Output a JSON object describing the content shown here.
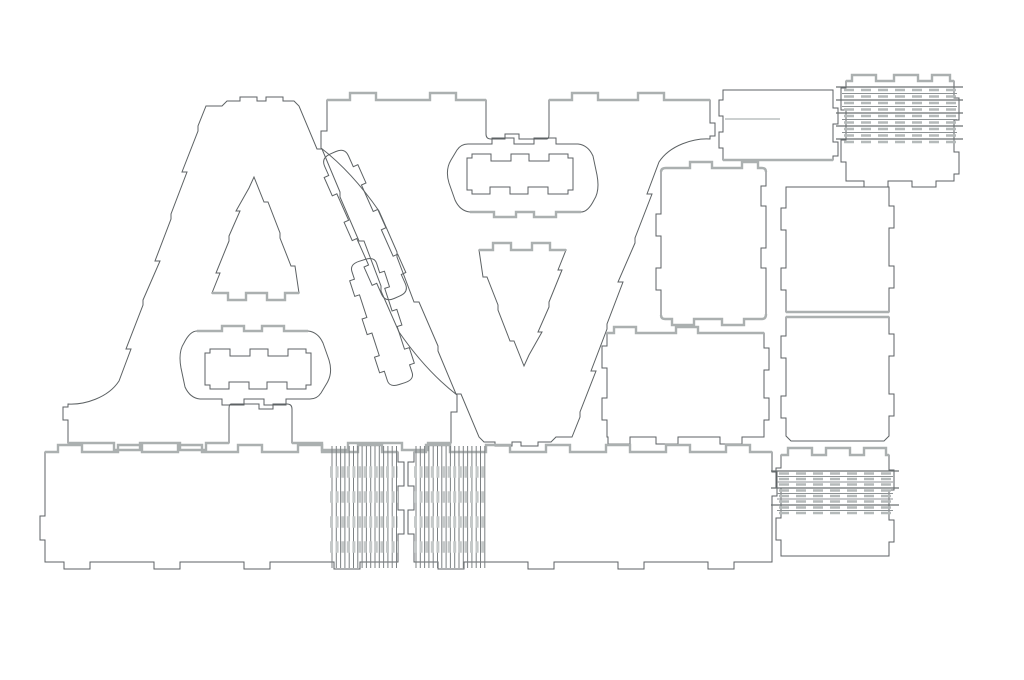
{
  "canvas": {
    "width": 1024,
    "height": 680,
    "background": "#ffffff"
  },
  "palette": {
    "cut": "#5d6264",
    "accent": "#abb0b0",
    "hinge_frame": "#6a6f71",
    "hinge_thin": "#8d9294",
    "hinge_dash": "#b5baba",
    "hinge_vertical": "#7c8183",
    "hinge_band": "#c5c9c9",
    "score": "#9aa0a0",
    "fill": "none"
  },
  "sheet": {
    "description": "laser-cut plywood letter kit cutting layout",
    "letter": "A",
    "letter_count": 2,
    "piece_kinds": [
      "letter-face",
      "crossbar-insert",
      "diagonal-wall-strip",
      "side-panel",
      "score-plate",
      "living-hinge-panel",
      "bottom-wall-strip"
    ]
  },
  "groups": [
    {
      "id": "letter-upright",
      "name": "letter-a-upright-group",
      "transform": ""
    },
    {
      "id": "letter-inverted",
      "name": "letter-a-inverted-group",
      "transform": "translate(254 0) rotate(180 262 271.5)"
    }
  ],
  "letter_paths": [
    {
      "id": "a-face",
      "name": "letter-a-face-outline",
      "d": "M 222,106 L 227,101 H 240 V 97 H 257 V 101 H 266 V 97 H 283 V 101 H 294 L 299,106 L 317,149 H 322 L 340,192 V 197 L 359,241 H 364 L 381,286 V 291 L 399,332 Q 426,371 457,395 V 412 H 451 V 443 H 428 V 450 H 402 V 443 H 348 V 450 H 322 V 443 H 292 V 409 Q 292,404 287,404 H 273 V 409 H 259 V 404 H 231 Q 229,404 229,409 V 443 H 206 V 450 H 180 V 443 H 140 V 450 H 114 V 443 H 68 V 420 H 63 V 407 H 68 V 404 C 84,405 108,398 119,381 L 131,349 H 126 L 143,305 V 300 L 160,261 H 155 L 171,219 V 214 L 187,172 H 182 L 198,131 V 126 L 206,106 Z M 254,177 L 264,202 H 268 L 280,233 V 238 L 291,266 H 295 L 299,293 H 285 V 300 H 267 V 293 H 246 V 300 H 228 V 293 H 212 L 220,273 H 216 L 229,241 V 236 L 240,211 H 236 L 249,188 Z M 197,331 H 222 V 326 H 244 V 331 H 262 V 326 H 284 V 331 H 308 Q 318,332 323,343 L 329,360 Q 333,373 327,383 L 321,393 Q 317,399 310,399 H 286 V 405 H 264 V 399 H 244 V 405 H 222 V 399 H 200 Q 190,398 185,387 L 181,368 Q 178,352 184,343 Q 190,331 197,331 Z"
    },
    {
      "id": "crossbar-insert",
      "name": "crossbar-insert-piece",
      "d": "M 210,349 H 230 V 356 H 250 V 349 H 268 V 356 H 288 V 349 H 306 V 353 H 311 V 385 H 306 V 389 H 287 V 382 H 267 V 389 H 249 V 382 H 229 V 389 H 210 V 385 H 205 V 353 H 210 Z"
    },
    {
      "id": "acc-stadium",
      "name": "stadium-top-accent",
      "class": "accent",
      "d": "M 197,331 H 222 V 326 H 244 V 331 H 262 V 326 H 284 V 331 H 308"
    },
    {
      "id": "acc-tri",
      "name": "triangle-base-accent",
      "class": "accent",
      "d": "M 299,293 H 285 V 300 H 267 V 293 H 246 V 300 H 228 V 293 H 212"
    },
    {
      "id": "acc-foot-l",
      "name": "left-foot-accent",
      "class": "accent",
      "d": "M 229,443 H 206 V 450 H 180 V 443 H 140 V 450 H 114 V 443 H 68"
    },
    {
      "id": "acc-foot-r",
      "name": "right-foot-accent",
      "class": "accent",
      "d": "M 451,443 H 428 V 450 H 402 V 443 H 348 V 450 H 322 V 443 H 292"
    }
  ],
  "pieces": [
    {
      "id": "strip-1",
      "name": "diagonal-wall-strip-1",
      "transform": "translate(365 225) rotate(66)",
      "d": "M -70,-13 H -58 V -18 H -38 V -13 H -9 V -18 H 11 V -13 H 40 V -18 H 60 V -13 H 70 Q 79,-13 79,-3 V 3 Q 79,13 70,13 H 58 V 18 H 38 V 13 H 9 V 18 H -11 V 13 H -40 V 18 H -60 V 13 H -70 Q -79,13 -79,3 V -3 Q -79,-13 -70,-13 Z"
    },
    {
      "id": "strip-2",
      "name": "diagonal-wall-strip-2",
      "transform": "translate(382 322) rotate(72) scale(0.82 1)",
      "d": "M -70,-13 H -58 V -18 H -38 V -13 H -9 V -18 H 11 V -13 H 40 V -18 H 60 V -13 H 70 Q 79,-13 79,-3 V 3 Q 79,13 70,13 H 58 V 18 H 38 V 13 H 9 V 18 H -11 V 13 H -40 V 18 H -60 V 13 H -70 Q -79,13 -79,3 V -3 Q -79,-13 -70,-13 Z"
    },
    {
      "id": "panel-1",
      "name": "side-panel-rounded-tall",
      "d": "M 666,168 H 690 V 162 H 712 V 168 H 742 V 162 H 758 V 168 H 762 Q 766,168 766,172 V 186 H 761 V 206 H 766 V 248 H 761 V 268 H 766 V 314 Q 766,319 762,319 H 744 V 325 H 722 V 319 H 694 V 325 H 672 V 319 H 665 Q 661,319 661,315 V 290 H 656 V 268 H 661 V 236 H 656 V 214 H 661 V 172 Q 661,168 666,168 Z"
    },
    {
      "id": "panel-2",
      "name": "side-panel-upper-right",
      "d": "M 786,187 H 889 V 206 H 894 V 228 H 889 V 266 H 894 V 288 H 889 V 312 H 786 V 290 H 781 V 268 H 786 V 230 H 781 V 208 H 786 Z"
    },
    {
      "id": "panel-3",
      "name": "side-panel-lower-right",
      "d": "M 786,317 H 889 V 334 H 894 V 356 H 889 V 394 H 894 V 416 H 889 V 436 L 884,441 H 791 L 786,436 V 418 H 781 V 396 H 786 V 358 H 781 V 336 H 786 Z"
    },
    {
      "id": "panel-4",
      "name": "side-panel-wide",
      "d": "M 607,333 H 614 V 327 H 636 V 333 H 676 V 327 H 698 V 333 H 764 V 348 H 769 V 370 H 764 V 398 H 769 V 420 H 764 V 437 H 742 V 444 H 720 V 437 H 678 V 444 H 656 V 437 H 630 V 444 H 608 V 437 H 607 V 420 H 602 V 398 H 607 V 368 H 602 V 346 H 607 Z"
    },
    {
      "id": "score-plate",
      "name": "score-plate",
      "d": "M 723,90 H 833 V 108 H 838 V 124 H 833 V 142 H 838 V 156 H 833 V 160 H 723 V 148 H 719 V 132 H 723 V 116 H 719 V 100 H 723 Z"
    },
    {
      "id": "hinge-panel-1",
      "name": "living-hinge-panel-top-right",
      "d": "M 846,81 H 852 V 75 H 876 V 81 H 894 V 75 H 918 V 81 H 932 V 75 H 950 V 81 H 954 V 98 H 959 V 120 H 954 V 152 H 959 V 174 H 954 V 181 H 936 V 187 H 912 V 181 H 888 V 187 H 864 V 181 H 846 V 162 H 841 V 140 H 846 V 110 H 841 V 88 H 846 Z"
    },
    {
      "id": "hinge-panel-2",
      "name": "living-hinge-panel-bottom-right",
      "d": "M 781,455 H 788 V 448 H 812 V 455 H 826 V 448 H 850 V 455 H 864 V 448 H 886 V 455 H 889 V 470 H 894 V 490 H 889 V 520 H 894 V 542 H 889 V 556 H 781 V 540 H 776 V 518 H 781 V 488 H 776 V 468 H 781 Z"
    },
    {
      "id": "bottom-strip-1",
      "name": "bottom-wall-strip-left",
      "d": "M 45,452 H 58 V 445 H 82 V 452 H 118 V 445 H 142 V 452 H 178 V 445 H 202 V 452 H 238 V 445 H 262 V 452 H 298 V 445 H 322 V 452 H 358 V 445 H 382 V 452 H 398 V 462 H 404 V 486 H 398 V 510 H 404 V 534 H 398 V 562 H 360 V 569 H 334 V 562 H 270 V 569 H 244 V 562 H 180 V 569 H 154 V 562 H 90 V 569 H 64 V 562 H 45 V 540 H 40 V 516 H 45 Z"
    },
    {
      "id": "bottom-strip-2",
      "name": "bottom-wall-strip-right",
      "d": "M 414,452 H 426 V 445 H 450 V 452 H 486 V 445 H 510 V 452 H 546 V 445 H 570 V 452 H 606 V 445 H 630 V 452 H 666 V 445 H 690 V 452 H 726 V 445 H 750 V 452 H 772 V 472 H 777 V 496 H 772 V 562 H 734 V 569 H 708 V 562 H 644 V 569 H 618 V 562 H 554 V 569 H 528 V 562 H 464 V 569 H 438 V 562 H 414 V 534 H 408 V 510 H 414 V 486 H 408 V 462 H 414 Z"
    }
  ],
  "accent_pieces": [
    {
      "id": "acc-s1-top",
      "name": "strip-left-top-accent",
      "d": "M 45,452 H 58 V 445 H 82 V 452 H 118 V 445 H 142 V 452 H 178 V 445 H 202 V 452 H 238 V 445 H 262 V 452 H 298 V 445 H 322 V 452 H 358 V 445 H 382 V 452 H 398"
    },
    {
      "id": "acc-s2-top",
      "name": "strip-right-top-accent",
      "d": "M 414,452 H 426 V 445 H 450 V 452 H 486 V 445 H 510 V 452 H 546 V 445 H 570 V 452 H 606 V 445 H 630 V 452 H 666 V 445 H 690 V 452 H 726 V 445 H 750 V 452 H 772"
    },
    {
      "id": "acc-p4-top",
      "name": "panel-wide-top-accent",
      "d": "M 607,333 H 614 V 327 H 636 V 333 H 676 V 327 H 698 V 333 H 764"
    },
    {
      "id": "acc-p1-top",
      "name": "panel-tall-top-accent",
      "d": "M 661,172 Q 661,168 666,168 H 690 V 162 H 712 V 168 H 742 V 162 H 758 V 168 H 762 Q 766,168 766,172"
    },
    {
      "id": "acc-p1-bottom",
      "name": "panel-tall-bottom-accent",
      "d": "M 766,314 Q 766,319 762,319 H 744 V 325 H 722 V 319 H 694 V 325 H 672 V 319 H 665 Q 661,319 661,315"
    },
    {
      "id": "acc-p2-bottom",
      "name": "panel-upper-right-bottom-accent",
      "d": "M 786,312 H 889"
    },
    {
      "id": "acc-p3-top",
      "name": "panel-lower-right-top-accent",
      "d": "M 786,317 H 889"
    },
    {
      "id": "acc-r-bottom",
      "name": "score-plate-bottom-accent",
      "d": "M 723,160 H 833"
    },
    {
      "id": "acc-h1-top",
      "name": "hinge-panel-1-top-accent",
      "d": "M 846,81 H 852 V 75 H 876 V 81 H 894 V 75 H 918 V 81 H 932 V 75 H 950 V 81 H 954"
    },
    {
      "id": "acc-h2-top",
      "name": "hinge-panel-2-top-accent",
      "d": "M 781,455 H 788 V 448 H 812 V 455 H 826 V 448 H 850 V 455 H 864 V 448 H 886 V 455 H 889"
    }
  ],
  "line_groups": [
    {
      "id": "h1-frame",
      "name": "hinge-1-frame-lines",
      "axis": "h",
      "from": 836,
      "to": 963,
      "at": [
        87,
        100,
        113,
        126,
        139
      ],
      "color": "hinge_frame",
      "width": 1.2
    },
    {
      "id": "h1-thin",
      "name": "hinge-1-thin-lines",
      "axis": "h",
      "from": 842,
      "to": 957,
      "at": [
        93.5,
        106.5,
        119.5,
        132.5
      ],
      "color": "hinge_thin",
      "width": 1
    },
    {
      "id": "h1-dash",
      "name": "hinge-1-dash-rows",
      "axis": "h",
      "from": 844,
      "to": 956,
      "at": [
        90,
        96.5,
        103,
        109.5,
        116,
        122.5,
        129,
        135.5,
        142
      ],
      "color": "hinge_dash",
      "width": 2.4,
      "dash": "10 7"
    },
    {
      "id": "h2-frame",
      "name": "hinge-2-frame-lines",
      "axis": "h",
      "from": 771,
      "to": 899,
      "at": [
        471,
        488,
        505
      ],
      "color": "hinge_frame",
      "width": 1.2
    },
    {
      "id": "h2-thin",
      "name": "hinge-2-thin-lines",
      "axis": "h",
      "from": 777,
      "to": 893,
      "at": [
        476.5,
        482,
        493.5,
        499,
        510.5
      ],
      "color": "hinge_thin",
      "width": 1
    },
    {
      "id": "h2-dash",
      "name": "hinge-2-dash-rows",
      "axis": "h",
      "from": 779,
      "to": 891,
      "at": [
        473.5,
        479,
        484.5,
        490.5,
        496,
        501.5,
        507.5,
        513
      ],
      "color": "hinge_dash",
      "width": 2.4,
      "dash": "10 7"
    },
    {
      "id": "s1-vlines",
      "name": "bottom-strip-1-hinge-lines",
      "axis": "v",
      "from": 446,
      "to": 568,
      "at": [
        332,
        336.3,
        340.6,
        344.9,
        349.2,
        353.5,
        357.8,
        362.1,
        366.4,
        370.7,
        375,
        379.3,
        383.6,
        387.9,
        392.2,
        396.5
      ],
      "color": "hinge_vertical",
      "width": 1
    },
    {
      "id": "s1-bands",
      "name": "bottom-strip-1-hinge-bands",
      "axis": "h",
      "from": 330,
      "to": 398,
      "at": [
        472,
        497,
        522,
        547
      ],
      "color": "hinge_band",
      "width": 11.5,
      "dash": "3 2.6"
    },
    {
      "id": "s2-vlines",
      "name": "bottom-strip-2-hinge-lines",
      "axis": "v",
      "from": 446,
      "to": 568,
      "at": [
        416,
        420.3,
        424.6,
        428.9,
        433.2,
        437.5,
        441.8,
        446.1,
        450.4,
        454.7,
        459,
        463.3,
        467.6,
        471.9,
        476.2,
        480.5,
        484.8
      ],
      "color": "hinge_vertical",
      "width": 1
    },
    {
      "id": "s2-bands",
      "name": "bottom-strip-2-hinge-bands",
      "axis": "h",
      "from": 414,
      "to": 486,
      "at": [
        472,
        497,
        522,
        547
      ],
      "color": "hinge_band",
      "width": 11.5,
      "dash": "3 2.6"
    },
    {
      "id": "r-score",
      "name": "score-plate-engrave-line",
      "axis": "h",
      "from": 725,
      "to": 780,
      "at": [
        119
      ],
      "color": "score",
      "width": 1
    }
  ]
}
